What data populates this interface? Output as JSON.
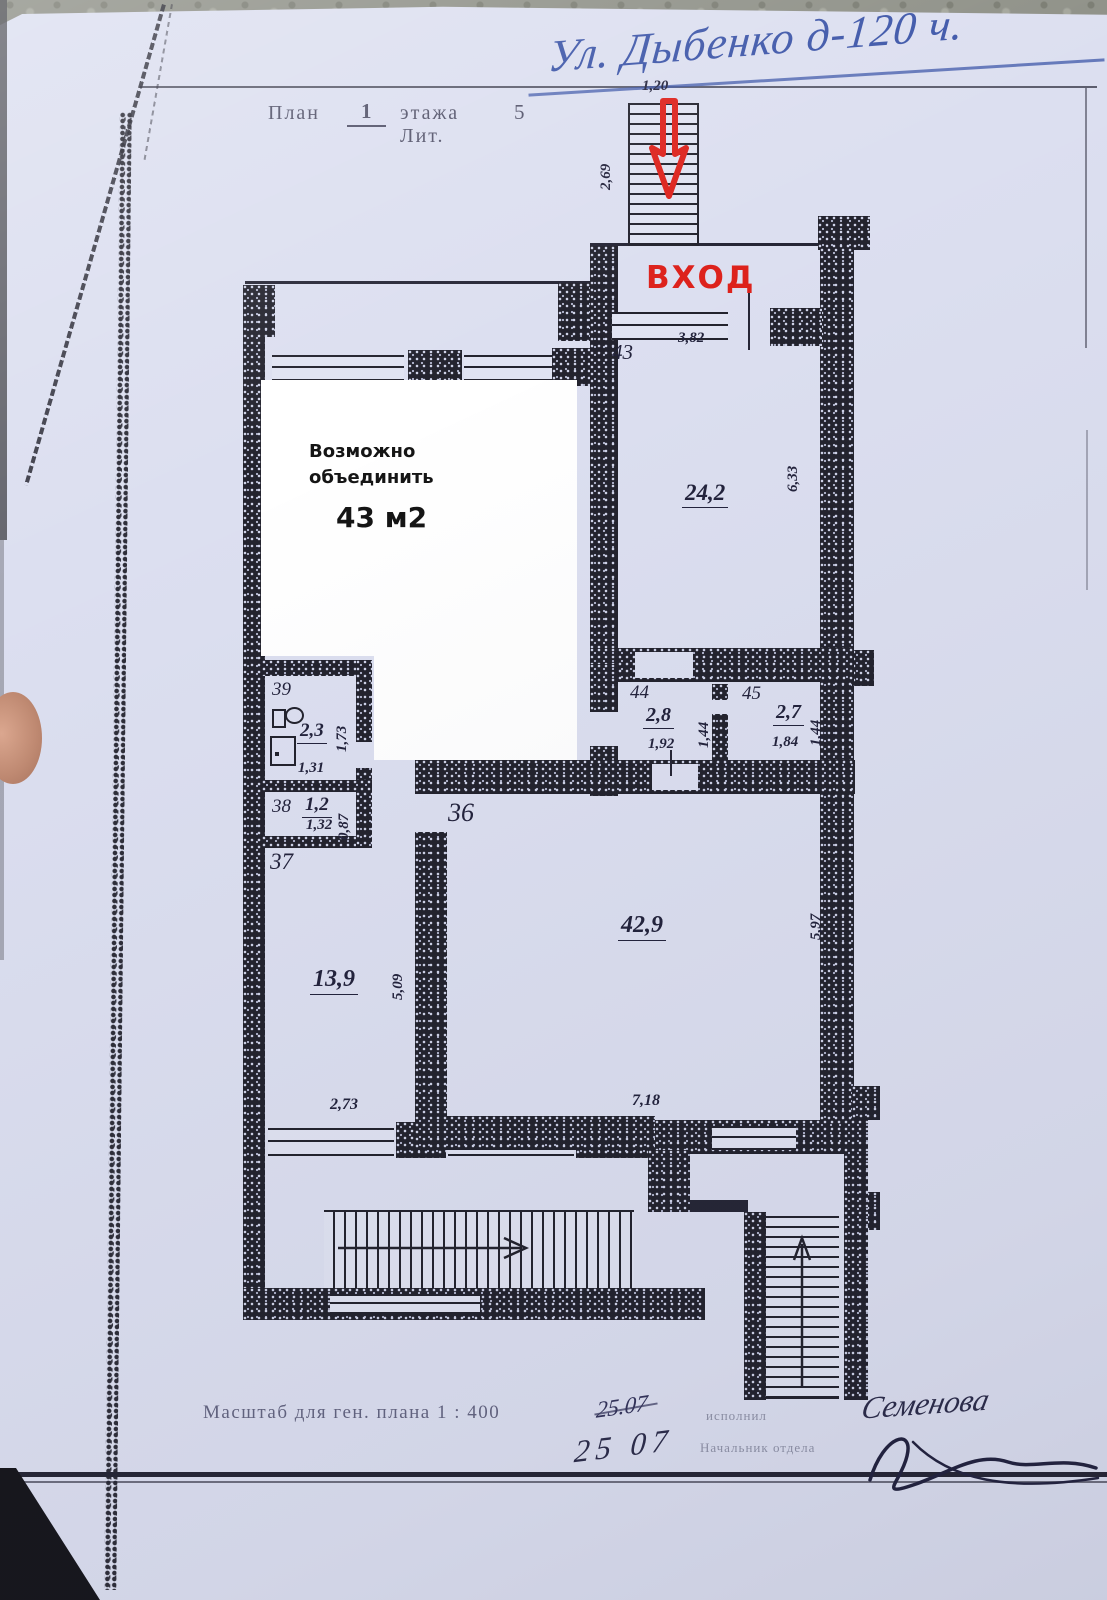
{
  "address_handwritten": "Ул. Дыбенко д-120 ч.",
  "title": {
    "word_plan": "План",
    "floor": "1",
    "word_floor": "этажа Лит.",
    "lit": "5"
  },
  "entrance": {
    "label": "ВХОД",
    "stair_width": "1,20",
    "stair_depth": "2,69"
  },
  "overlay": {
    "line1": "Возможно",
    "line2": "объединить",
    "area": "43 м2"
  },
  "rooms": {
    "r43": {
      "number": "43",
      "area": "24,2",
      "dim_top": "3,82",
      "dim_right": "6,33"
    },
    "r44": {
      "number": "44",
      "area": "2,8",
      "w": "1,92",
      "h": "1,44"
    },
    "r45": {
      "number": "45",
      "area": "2,7",
      "w": "1,84",
      "h": "1,44"
    },
    "r39": {
      "number": "39",
      "area": "2,3",
      "w": "1,31",
      "h": "1,73"
    },
    "r38": {
      "number": "38",
      "area": "1,2",
      "w": "1,32",
      "h": "0,87"
    },
    "r37": {
      "number": "37",
      "area": "13,9",
      "w": "2,73",
      "h": "5,09"
    },
    "r36": {
      "number": "36",
      "area": "42,9",
      "w": "7,18",
      "h": "5,97"
    }
  },
  "footer": {
    "scale": "Масштаб для ген. плана 1 : 400",
    "date_line1": "25.07",
    "date_line2": "25 07",
    "role1": "исполнил",
    "role2": "Начальник отдела",
    "signature1": "Семенова"
  },
  "colors": {
    "paper": "#dcdff0",
    "ink": "#23232e",
    "red_accent": "#dd221c",
    "pen_blue": "#3c55a8",
    "white_overlay": "#ffffff"
  }
}
